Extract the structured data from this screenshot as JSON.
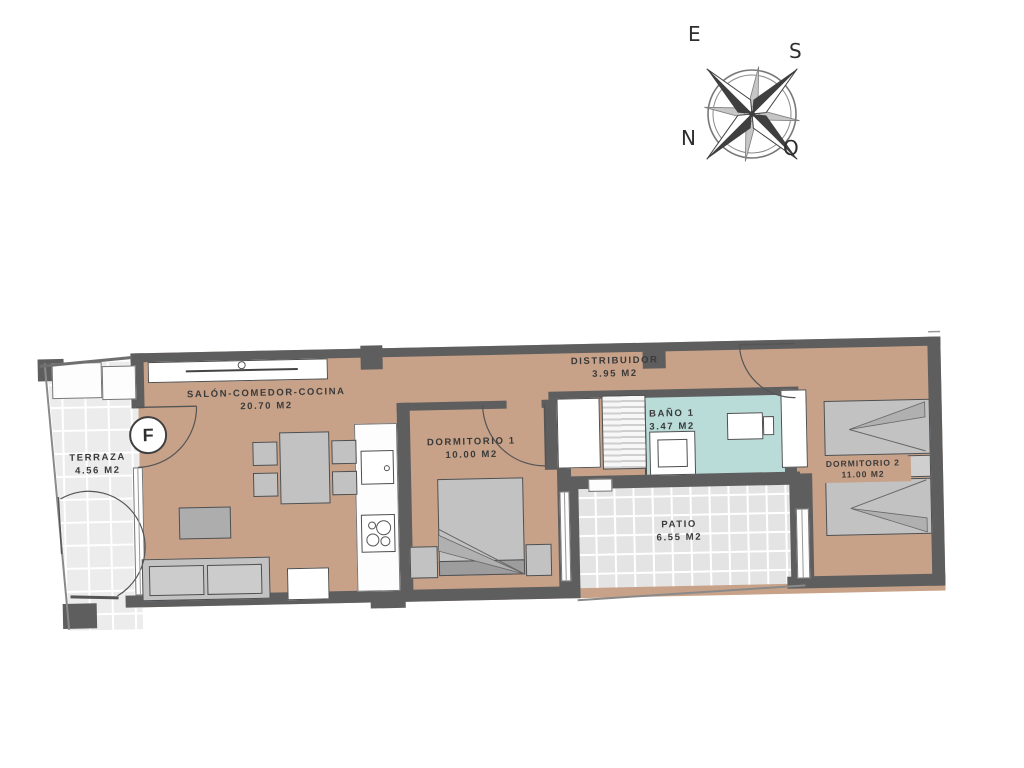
{
  "compass": {
    "e": "E",
    "s": "S",
    "n": "N",
    "o": "O"
  },
  "unit": {
    "letter": "F"
  },
  "rooms": {
    "terraza": {
      "name": "TERRAZA",
      "area": "4.56 M2"
    },
    "salon": {
      "name": "SALÓN-COMEDOR-COCINA",
      "area": "20.70 M2"
    },
    "dormitorio1": {
      "name": "DORMITORIO 1",
      "area": "10.00 M2"
    },
    "distribuidor": {
      "name": "DISTRIBUIDOR",
      "area": "3.95 M2"
    },
    "bano1": {
      "name": "BAÑO 1",
      "area": "3.47 M2"
    },
    "dormitorio2": {
      "name": "DORMITORIO 2",
      "area": "11.00 M2"
    },
    "patio": {
      "name": "PATIO",
      "area": "6.55 M2"
    }
  },
  "colors": {
    "floor": "#c7a289",
    "wall": "#5e5e5e",
    "bathroom": "#b9dcd9",
    "patio_tile": "#e4e4e4",
    "terraza_tile": "#ececec",
    "furniture": "#c2c2c2"
  }
}
